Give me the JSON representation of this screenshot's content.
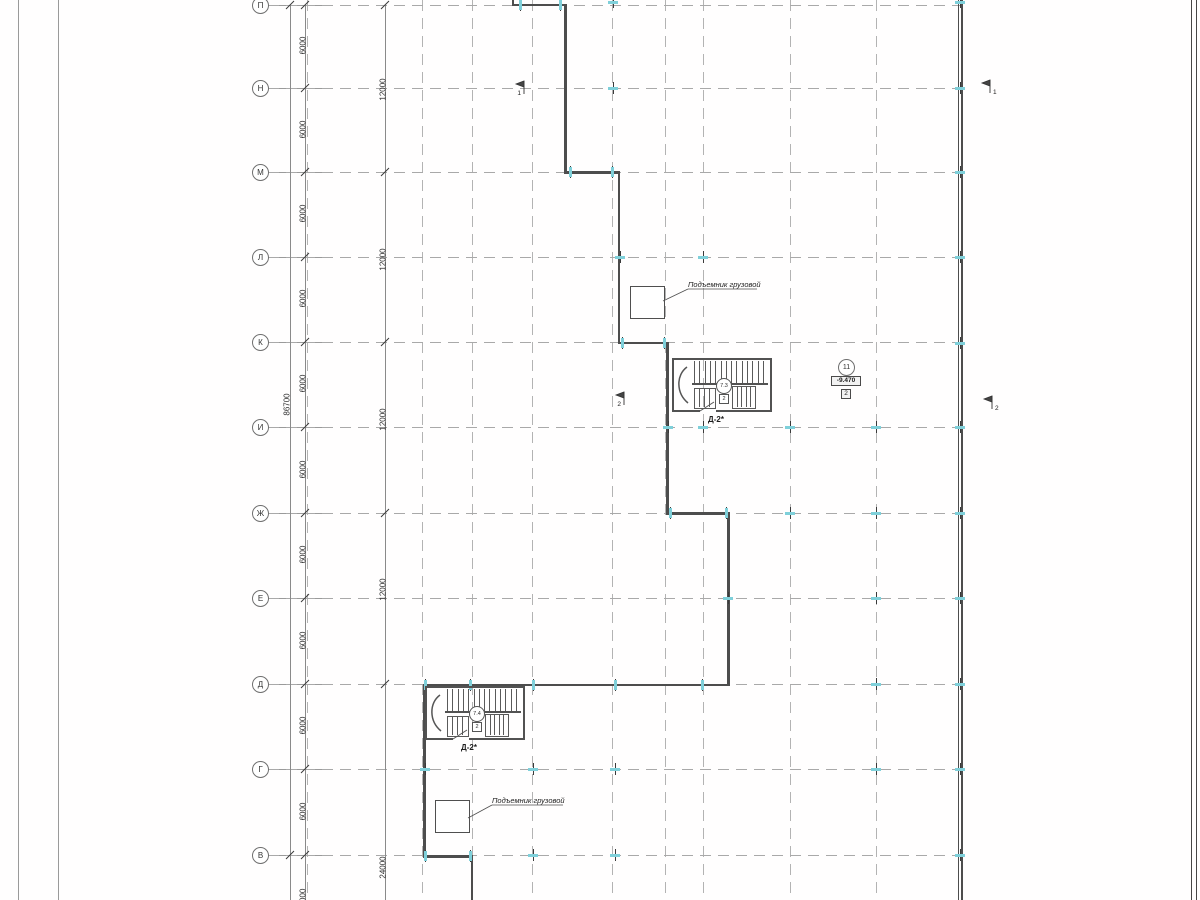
{
  "canvas": {
    "w": 1200,
    "h": 900
  },
  "colors": {
    "wall": "#4d4d4d",
    "grid": "#b3b3b3",
    "dim": "#8a8a8a",
    "text": "#2e2e2e",
    "tick": "#7fd0da",
    "tick_dark": "#3a3a3a",
    "frame": "#9a9a9a",
    "border": "#474747"
  },
  "frame": {
    "left_lines_x": [
      18,
      58
    ],
    "right_lines_x": [
      1191,
      1196
    ]
  },
  "rows": [
    {
      "label": "П",
      "y": 5
    },
    {
      "label": "Н",
      "y": 88
    },
    {
      "label": "М",
      "y": 172
    },
    {
      "label": "Л",
      "y": 257
    },
    {
      "label": "К",
      "y": 342
    },
    {
      "label": "И",
      "y": 427
    },
    {
      "label": "Ж",
      "y": 513
    },
    {
      "label": "Е",
      "y": 598
    },
    {
      "label": "Д",
      "y": 684
    },
    {
      "label": "Г",
      "y": 769
    },
    {
      "label": "В",
      "y": 855
    }
  ],
  "row_line": {
    "x1": 268,
    "x2": 960
  },
  "columns": [
    307,
    422,
    472,
    532,
    612,
    665,
    703,
    790,
    876
  ],
  "dim_lines": {
    "overall_x": 290,
    "seg_x": 305,
    "major_x": 385,
    "y1": 5,
    "y2": 900
  },
  "dims_6000": {
    "value": "6000",
    "x": 303,
    "ys": [
      46,
      130,
      214,
      299,
      384,
      470,
      555,
      641,
      726,
      812,
      898
    ]
  },
  "dims_12000": {
    "value": "12000",
    "x": 383,
    "ys": [
      90,
      260,
      420,
      590
    ]
  },
  "dim_24000": {
    "value": "24000",
    "x": 383,
    "y": 868
  },
  "dim_overall": {
    "value": "86700",
    "x": 287,
    "y": 405
  },
  "slashes": {
    "seg": [
      5,
      88,
      172,
      257,
      342,
      427,
      513,
      598,
      684,
      769,
      855
    ],
    "major": [
      5,
      172,
      342,
      513,
      684
    ],
    "overall": [
      5,
      855
    ]
  },
  "walls": [
    [
      512,
      0,
      2,
      6
    ],
    [
      512,
      3.5,
      55,
      2.5
    ],
    [
      564,
      3.5,
      2.5,
      170
    ],
    [
      564,
      171,
      56,
      2.5
    ],
    [
      617.5,
      171,
      2.5,
      173
    ],
    [
      617.5,
      341.5,
      51,
      2.5
    ],
    [
      666,
      341.5,
      2.5,
      173
    ],
    [
      666,
      512,
      63.5,
      2.5
    ],
    [
      727,
      512,
      2.5,
      174
    ],
    [
      423,
      683.5,
      306.5,
      2.5
    ],
    [
      423,
      683.5,
      2.5,
      174
    ],
    [
      423,
      855,
      50,
      2.5
    ],
    [
      470.5,
      855,
      2.5,
      45
    ],
    [
      958,
      0,
      1.4,
      900
    ],
    [
      961.2,
      0,
      1.4,
      900
    ]
  ],
  "ticks": [
    {
      "x": 520,
      "y": 5,
      "o": "v"
    },
    {
      "x": 560,
      "y": 5,
      "o": "v"
    },
    {
      "x": 613,
      "y": 2,
      "o": "h"
    },
    {
      "x": 960,
      "y": 2,
      "o": "h"
    },
    {
      "x": 613,
      "y": 88,
      "o": "h"
    },
    {
      "x": 960,
      "y": 88,
      "o": "h"
    },
    {
      "x": 570,
      "y": 172,
      "o": "v"
    },
    {
      "x": 612,
      "y": 172,
      "o": "v"
    },
    {
      "x": 960,
      "y": 172,
      "o": "h"
    },
    {
      "x": 620,
      "y": 257,
      "o": "h"
    },
    {
      "x": 703,
      "y": 257,
      "o": "h"
    },
    {
      "x": 960,
      "y": 257,
      "o": "h"
    },
    {
      "x": 622,
      "y": 343,
      "o": "v"
    },
    {
      "x": 664,
      "y": 343,
      "o": "v"
    },
    {
      "x": 960,
      "y": 343,
      "o": "h"
    },
    {
      "x": 668,
      "y": 427,
      "o": "h"
    },
    {
      "x": 703,
      "y": 427,
      "o": "h"
    },
    {
      "x": 790,
      "y": 427,
      "o": "h"
    },
    {
      "x": 876,
      "y": 427,
      "o": "h"
    },
    {
      "x": 960,
      "y": 427,
      "o": "h"
    },
    {
      "x": 670,
      "y": 513,
      "o": "v"
    },
    {
      "x": 726,
      "y": 513,
      "o": "v"
    },
    {
      "x": 790,
      "y": 513,
      "o": "h"
    },
    {
      "x": 876,
      "y": 513,
      "o": "h"
    },
    {
      "x": 960,
      "y": 513,
      "o": "h"
    },
    {
      "x": 728,
      "y": 598,
      "o": "h"
    },
    {
      "x": 876,
      "y": 598,
      "o": "h"
    },
    {
      "x": 960,
      "y": 598,
      "o": "h"
    },
    {
      "x": 425,
      "y": 685,
      "o": "v"
    },
    {
      "x": 470,
      "y": 685,
      "o": "v"
    },
    {
      "x": 533,
      "y": 685,
      "o": "v"
    },
    {
      "x": 615,
      "y": 685,
      "o": "v"
    },
    {
      "x": 702,
      "y": 685,
      "o": "v"
    },
    {
      "x": 876,
      "y": 684,
      "o": "h"
    },
    {
      "x": 960,
      "y": 684,
      "o": "h"
    },
    {
      "x": 425,
      "y": 769,
      "o": "h"
    },
    {
      "x": 533,
      "y": 769,
      "o": "h"
    },
    {
      "x": 615,
      "y": 769,
      "o": "h"
    },
    {
      "x": 876,
      "y": 769,
      "o": "h"
    },
    {
      "x": 960,
      "y": 769,
      "o": "h"
    },
    {
      "x": 425,
      "y": 856,
      "o": "v"
    },
    {
      "x": 470,
      "y": 856,
      "o": "v"
    },
    {
      "x": 533,
      "y": 855,
      "o": "h"
    },
    {
      "x": 615,
      "y": 855,
      "o": "h"
    },
    {
      "x": 960,
      "y": 855,
      "o": "h"
    }
  ],
  "stairs": [
    {
      "x": 672,
      "y": 358,
      "w": 100,
      "h": 54,
      "room": "7.3",
      "tag": "2",
      "label": "Д-2*"
    },
    {
      "x": 425,
      "y": 686,
      "w": 100,
      "h": 54,
      "room": "7.4",
      "tag": "2",
      "label": "Д-2*"
    }
  ],
  "lifts": [
    {
      "label": "Подъемник грузовой",
      "box": [
        630,
        286,
        33,
        31
      ],
      "leader": [
        663,
        301,
        688,
        289
      ],
      "text_x": 688,
      "text_y": 280,
      "underline_to": 757
    },
    {
      "label": "Подъемник грузовой",
      "box": [
        435,
        800,
        33,
        31
      ],
      "leader": [
        468,
        818,
        492,
        805
      ],
      "text_x": 492,
      "text_y": 796,
      "underline_to": 563
    }
  ],
  "flags": [
    {
      "num": "1",
      "x": 524,
      "y": 89,
      "side": "left"
    },
    {
      "num": "1",
      "x": 990,
      "y": 88,
      "side": "right"
    },
    {
      "num": "2",
      "x": 624,
      "y": 400,
      "side": "left"
    },
    {
      "num": "2",
      "x": 992,
      "y": 404,
      "side": "right"
    }
  ],
  "badge": {
    "circle_text": "11",
    "elev_text": "-9.470",
    "box_text": "2",
    "cx": 846,
    "cy": 367
  }
}
